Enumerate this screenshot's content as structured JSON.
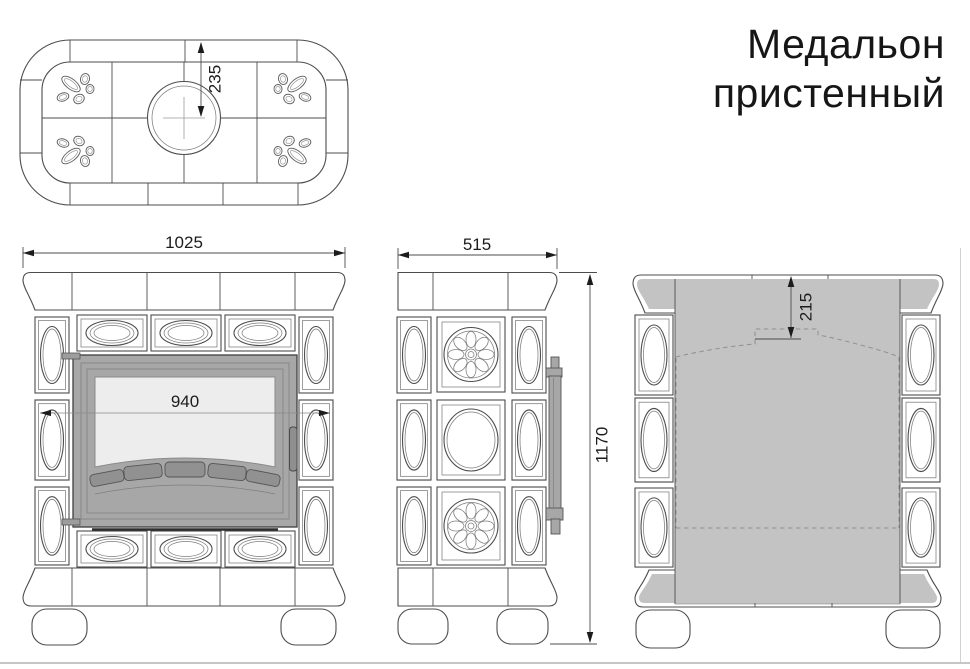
{
  "title": {
    "line1": "Медальон",
    "line2": "пристенный"
  },
  "views": {
    "top": {
      "label": "top-view",
      "dim_flue_center": "235"
    },
    "front": {
      "label": "front-view",
      "dim_width": "1025",
      "dim_inner_width": "940"
    },
    "side": {
      "label": "side-view",
      "dim_depth": "515",
      "dim_height": "1170"
    },
    "back": {
      "label": "back-view",
      "dim_flue_offset": "215"
    }
  },
  "colors": {
    "line": "#4d4d4d",
    "shade_gray": "#c3c3c3",
    "door_frame_gray": "#a7a7a7",
    "door_edge_gray": "#9d9d9d",
    "glass_gray": "#ededed",
    "vent_gray": "#919191",
    "handle_gray": "#8f8f8f"
  }
}
